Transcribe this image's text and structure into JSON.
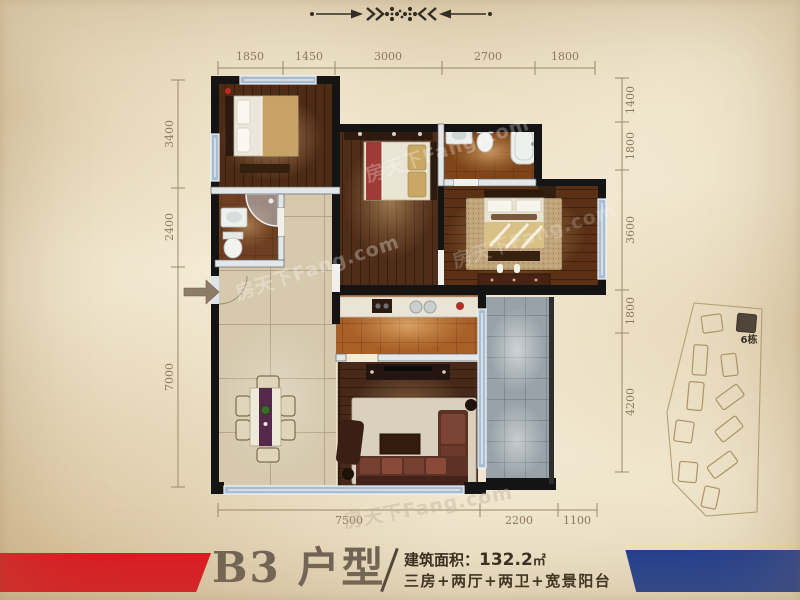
{
  "plan": {
    "dims_top": [
      "1850",
      "1450",
      "3000",
      "2700",
      "1800"
    ],
    "dims_left": [
      "3400",
      "2400",
      "7000"
    ],
    "dims_right": [
      "1400",
      "1800",
      "3600",
      "1800",
      "4200"
    ],
    "dims_bottom": [
      "7500",
      "2200",
      "1100"
    ]
  },
  "sitemap": {
    "building_label": "6栋"
  },
  "watermark": {
    "text": "房天下Fang.com"
  },
  "footer": {
    "title": "B3 户型",
    "area_label": "建筑面积：",
    "area_value": "132.2",
    "area_unit": "㎡",
    "description": "三房+两厅+两卫+宽景阳台",
    "accent_red": "#dd1520",
    "accent_blue": "#1d3c92"
  }
}
